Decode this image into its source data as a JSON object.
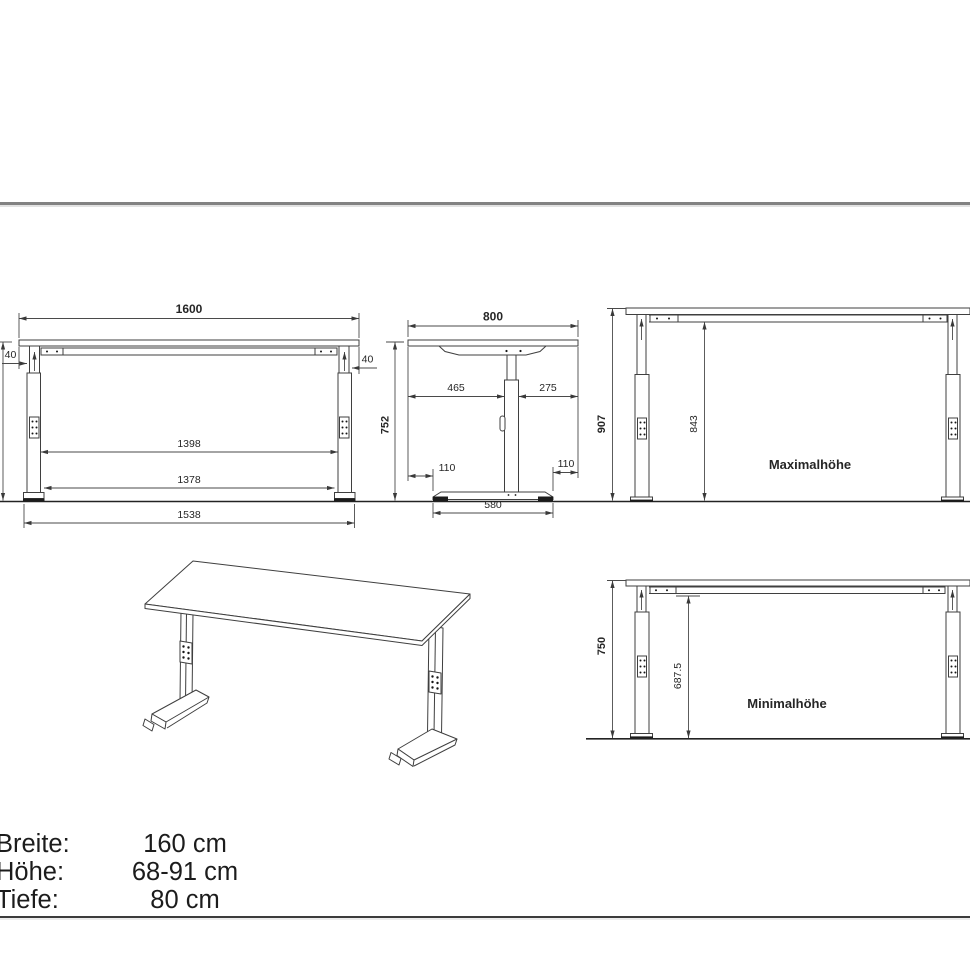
{
  "views": {
    "front": {
      "width": "1600",
      "overhang_left": "40",
      "overhang_right": "40",
      "frame_inner_width": "1398",
      "leg_inner_width": "1378",
      "foot_span": "1538",
      "height": "752"
    },
    "side": {
      "depth": "800",
      "front_of_column": "465",
      "back_of_column": "275",
      "overhang_front": "110",
      "overhang_back": "110",
      "foot_depth": "580"
    },
    "max": {
      "total_height": "907",
      "clearance": "843",
      "label": "Maximalhöhe"
    },
    "min": {
      "total_height": "750",
      "clearance": "687.5",
      "label": "Minimalhöhe"
    }
  },
  "specs": {
    "rows": [
      {
        "label": "Breite:",
        "value": "160 cm"
      },
      {
        "label": "Höhe:",
        "value": "68-91 cm"
      },
      {
        "label": "Tiefe:",
        "value": "80 cm"
      }
    ]
  }
}
